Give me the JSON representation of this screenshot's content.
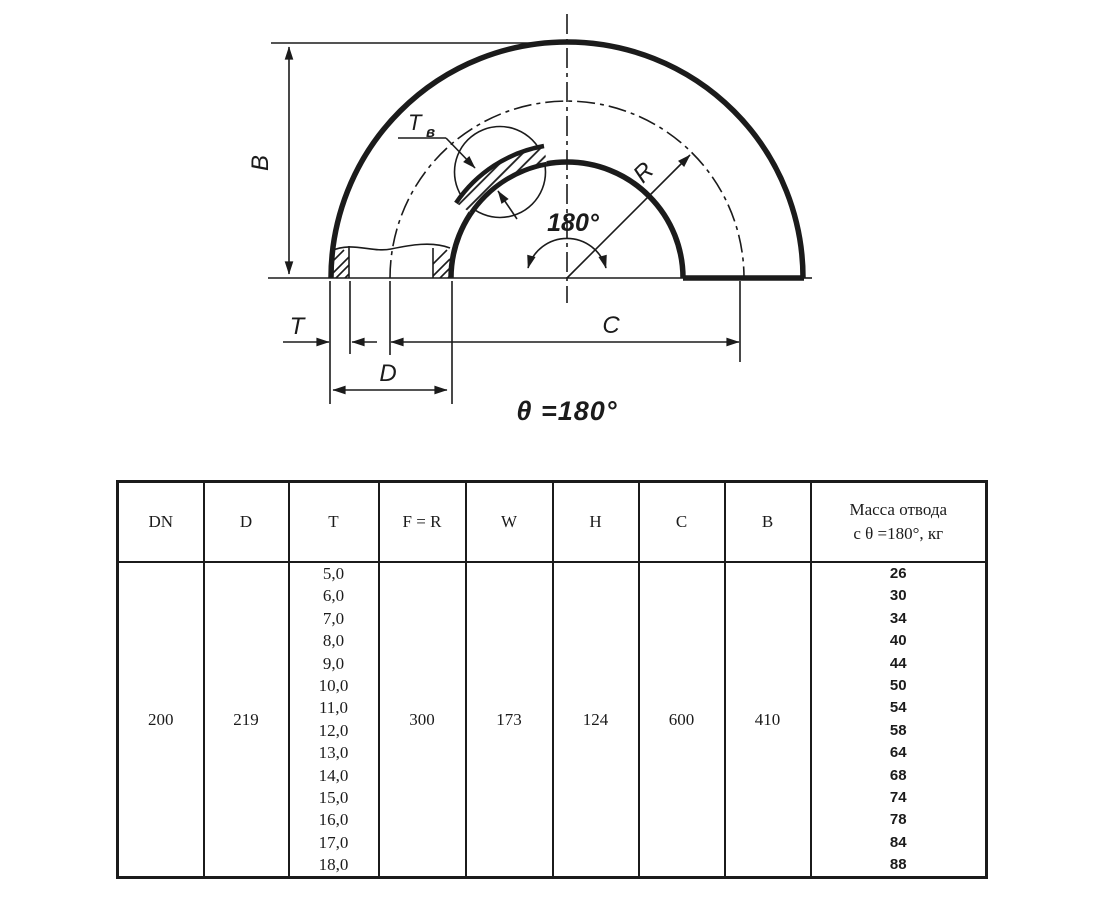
{
  "colors": {
    "ink": "#1b1b1b",
    "background": "#ffffff"
  },
  "diagram": {
    "labels": {
      "b": "B",
      "t": "T",
      "d": "D",
      "c": "C",
      "r": "R",
      "t_wall_main": "T",
      "t_wall_sub": "в",
      "angle": "180°",
      "theta_caption": "θ =180°"
    }
  },
  "table": {
    "headers": [
      "DN",
      "D",
      "T",
      "F = R",
      "W",
      "H",
      "C",
      "B"
    ],
    "mass_header_line1": "Масса отвода",
    "mass_header_line2": "с θ =180°, кг",
    "row": {
      "dn": "200",
      "d": "219",
      "t_values": [
        "5,0",
        "6,0",
        "7,0",
        "8,0",
        "9,0",
        "10,0",
        "11,0",
        "12,0",
        "13,0",
        "14,0",
        "15,0",
        "16,0",
        "17,0",
        "18,0"
      ],
      "f_r": "300",
      "w": "173",
      "h": "124",
      "c": "600",
      "b": "410",
      "mass_values": [
        "26",
        "30",
        "34",
        "40",
        "44",
        "50",
        "54",
        "58",
        "64",
        "68",
        "74",
        "78",
        "84",
        "88"
      ]
    }
  }
}
